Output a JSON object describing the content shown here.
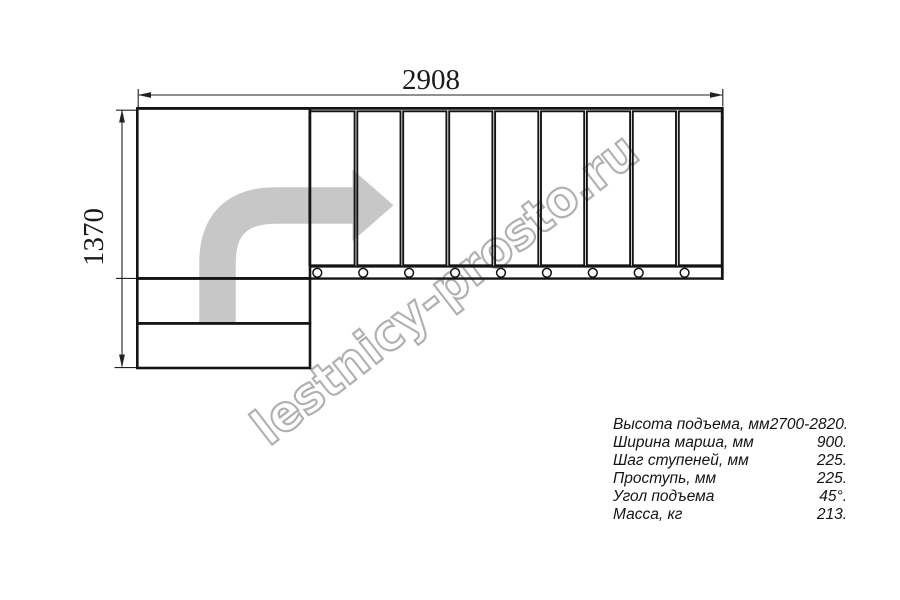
{
  "drawing": {
    "title": "staircase-plan-top-view",
    "dimension_top": "2908",
    "dimension_left": "1370",
    "tread_count": 9,
    "lower_step_count": 2
  },
  "watermark": {
    "text": "lestnicy-prosto.ru"
  },
  "specs": {
    "rows": [
      {
        "label": "Высота подъема, мм",
        "value": "2700-2820."
      },
      {
        "label": "Ширина марша, мм",
        "value": "900."
      },
      {
        "label": "Шаг ступеней, мм",
        "value": "225."
      },
      {
        "label": "Проступь, мм",
        "value": "225."
      },
      {
        "label": "Угол подъема",
        "value": "45°."
      },
      {
        "label": "Масса, кг",
        "value": "213."
      }
    ]
  },
  "colors": {
    "line": "#141414",
    "dimension_line": "#222222",
    "arrow_fill": "#c7c7c7",
    "watermark_outline": "#b0b0b0",
    "background": "#ffffff"
  }
}
